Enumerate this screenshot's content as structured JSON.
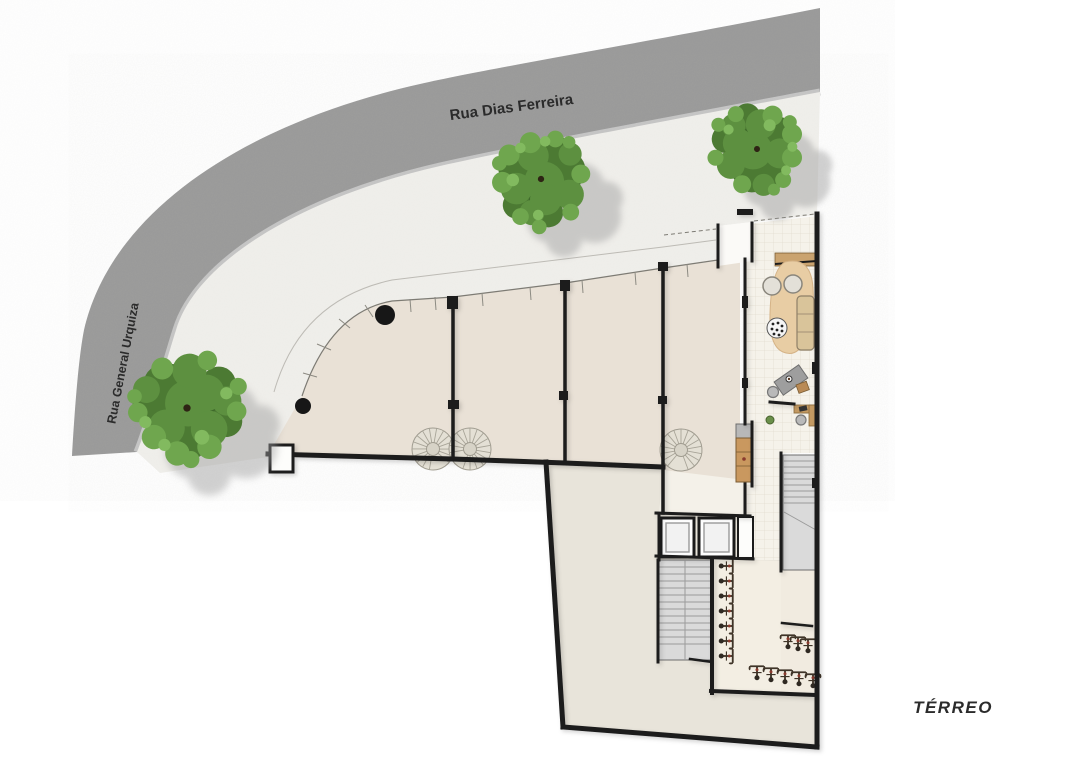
{
  "labels": {
    "street_top": "Rua Dias Ferreira",
    "street_left": "Rua General Urquiza",
    "floor": "TÉRREO"
  },
  "colors": {
    "street": "#9a9a9a",
    "sidewalk": "#f0efeb",
    "floor": "#e9e1d6",
    "floor_lower": "#e8e4da",
    "lobby_tile": "#f5f2ea",
    "wall": "#1b1b1b",
    "stair": "#dadada",
    "wood": "#c49a62",
    "rug": "#e7cba0",
    "tree_green": "#5d9040"
  }
}
